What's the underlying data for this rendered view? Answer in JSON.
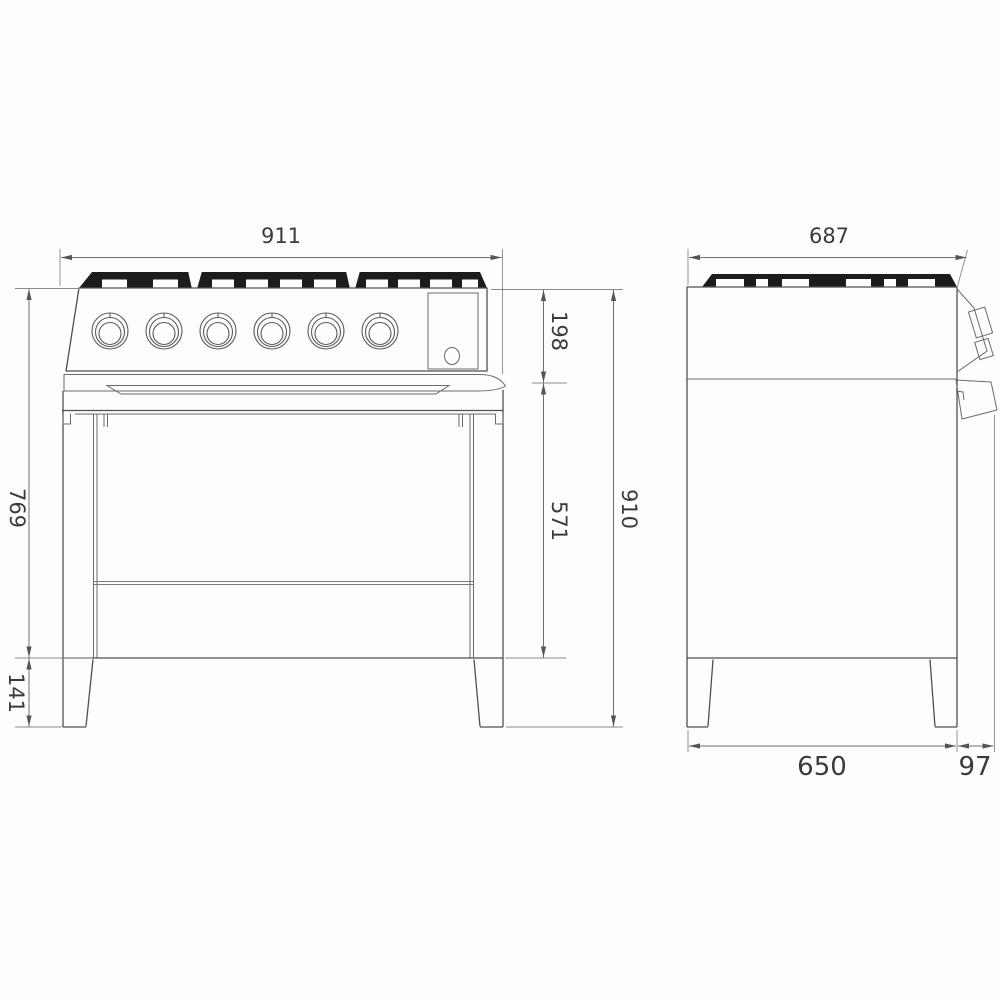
{
  "drawing": {
    "subject": "range-cooker-dimension-drawing",
    "colors": {
      "background": "#fdfdfd",
      "line": "#4f4f4f",
      "dimension_line": "#6f6f6f",
      "grate_fill": "#1c1c1c",
      "text": "#3b3b3b"
    }
  },
  "dimensions": {
    "front": {
      "width": "911",
      "cooktop_height": "198",
      "body_height": "769",
      "oven_height": "571",
      "total_height": "910",
      "leg_height": "141"
    },
    "side": {
      "width": "687",
      "base_depth": "650",
      "handle_depth": "97"
    }
  }
}
